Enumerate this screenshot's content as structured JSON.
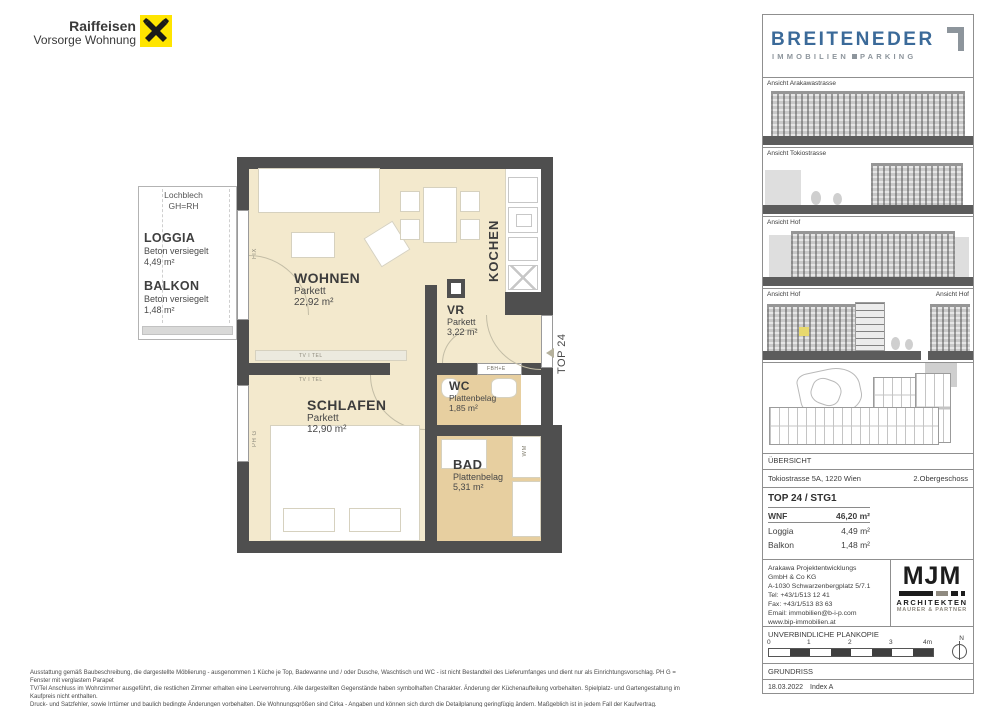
{
  "brand": {
    "name": "Raiffeisen",
    "tagline": "Vorsorge Wohnung"
  },
  "plan": {
    "annex": {
      "note1": "Lochblech",
      "note2": "GH=RH",
      "loggia_name": "LOGGIA",
      "loggia_finish": "Beton versiegelt",
      "loggia_area": "4,49 m²",
      "balkon_name": "BALKON",
      "balkon_finish": "Beton versiegelt",
      "balkon_area": "1,48 m²"
    },
    "wohnen": {
      "name": "WOHNEN",
      "finish": "Parkett",
      "area": "22,92 m²"
    },
    "schlafen": {
      "name": "SCHLAFEN",
      "finish": "Parkett",
      "area": "12,90 m²"
    },
    "vr": {
      "name": "VR",
      "finish": "Parkett",
      "area": "3,22 m²"
    },
    "wc": {
      "name": "WC",
      "finish": "Plattenbelag",
      "area": "1,85 m²"
    },
    "bad": {
      "name": "BAD",
      "finish": "Plattenbelag",
      "area": "5,31 m²"
    },
    "kochen": {
      "name": "KOCHEN"
    },
    "labels": {
      "fix": "FIX",
      "ph_g": "PH G",
      "tv_tel_1": "TV I TEL",
      "tv_tel_2": "TV I TEL",
      "fbh_e": "FBH+E",
      "wm": "WM",
      "unit": "TOP 24"
    }
  },
  "sidebar": {
    "logo": {
      "name": "BREITENEDER",
      "word1": "IMMOBILIEN",
      "word2": "PARKING"
    },
    "elevations": [
      {
        "label": "Ansicht Arakawastrasse"
      },
      {
        "label": "Ansicht Tokiostrasse"
      },
      {
        "label": "Ansicht Hof"
      },
      {
        "label": "Ansicht Hof"
      },
      {
        "label": "Ansicht Hof"
      }
    ],
    "overview_label": "ÜBERSICHT",
    "address": "Tokiostrasse 5A, 1220 Wien",
    "floor": "2.Obergeschoss",
    "unit_title": "TOP 24 / STG1",
    "areas": [
      {
        "label": "WNF",
        "value": "46,20 m²"
      },
      {
        "label": "Loggia",
        "value": "4,49 m²"
      },
      {
        "label": "Balkon",
        "value": "1,48 m²"
      }
    ],
    "developer_lines": [
      "Arakawa Projektentwicklungs",
      "GmbH & Co KG",
      "A-1030 Schwarzenbergplatz 5/7.1",
      "Tel: +43/1/513 12 41",
      "Fax: +43/1/513 83 63",
      "Email: immobilien@b-i-p.com",
      "www.bip-immobilien.at"
    ],
    "architects": {
      "logo": "MJM",
      "line1": "ARCHITEKTEN",
      "line2": "MAURER & PARTNER"
    },
    "plancopy": "UNVERBINDLICHE PLANKOPIE",
    "scale_ticks": [
      "0",
      "1",
      "2",
      "3",
      "4m"
    ],
    "north": "N",
    "plan_type": "GRUNDRISS",
    "date": "18.03.2022",
    "index": "Index A"
  },
  "footer": {
    "line1": "Ausstattung gemäß Baubeschreibung, die dargestellte Möblierung - ausgenommen 1 Küche je Top, Badewanne und / oder Dusche, Waschtisch und WC - ist nicht Bestandteil des Lieferumfanges und dient nur als Einrichtungsvorschlag. PH G = Fenster mit verglastem Parapet",
    "line2": "TV/Tel Anschluss im Wohnzimmer ausgeführt, die restlichen Zimmer erhalten eine Leerverrohrung. Alle dargestellten Gegenstände haben symbolhaften Charakter. Änderung der Küchenaufteilung vorbehalten. Spielplatz- und Gartengestaltung im Kaufpreis nicht enthalten.",
    "line3": "Druck- und Satzfehler, sowie Irrtümer und baulich bedingte Änderungen vorbehalten. Die Wohnungsgrößen sind Cirka - Angaben und können sich durch die Detailplanung geringfügig ändern. Maßgeblich ist in jedem Fall der Kaufvertrag."
  }
}
